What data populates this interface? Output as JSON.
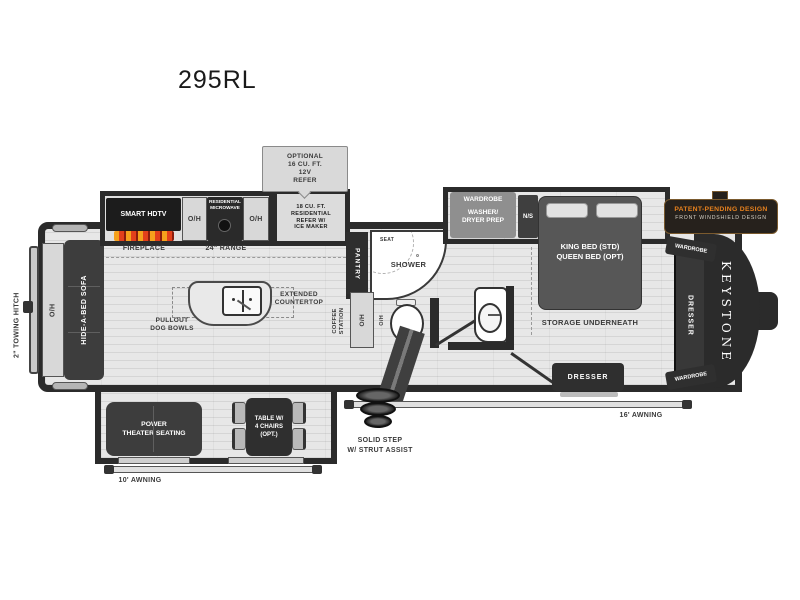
{
  "title": "295RL",
  "brand": "KEYSTONE",
  "badge": {
    "line1": "PATENT-PENDING DESIGN",
    "line2": "FRONT WINDSHIELD DESIGN"
  },
  "labels": {
    "oh": "O/H",
    "optional_refer": "OPTIONAL\n16 CU. FT.\n12V\nREFER",
    "smart_hdtv": "SMART HDTV",
    "fireplace": "FIREPLACE",
    "microwave": "RESIDENTIAL\nMICROWAVE",
    "range": "24\" RANGE",
    "refer": "18 CU. FT.\nRESIDENTIAL\nREFER W/\nICE MAKER",
    "pantry": "PANTRY",
    "seat": "SEAT",
    "shower": "SHOWER",
    "coffee_station": "COFFEE\nSTATION",
    "extended_countertop": "EXTENDED\nCOUNTERTOP",
    "pullout_dog_bowls": "PULLOUT\nDOG BOWLS",
    "hide_a_bed_sofa": "HIDE-A-BED SOFA",
    "towing_hitch": "2\" TOWING HITCH",
    "power_theater_seating": "POWER\nTHEATER SEATING",
    "table_chairs": "TABLE W/\n4 CHAIRS\n(OPT.)",
    "awning_10": "10' AWNING",
    "awning_16": "16' AWNING",
    "solid_step": "SOLID STEP\nW/ STRUT ASSIST",
    "wardrobe": "WARDROBE",
    "washer_dryer": "WASHER/\nDRYER PREP",
    "nightstand": "N/S",
    "bed": "KING BED (STD)\nQUEEN BED (OPT)",
    "storage": "STORAGE UNDERNEATH",
    "dresser": "DRESSER"
  },
  "colors": {
    "wall": "#2b2b2b",
    "floor": "#e7e7e7",
    "badge_orange": "#e8821e",
    "flame_orange": "#f5a11c",
    "flame_red": "#e2401b"
  }
}
